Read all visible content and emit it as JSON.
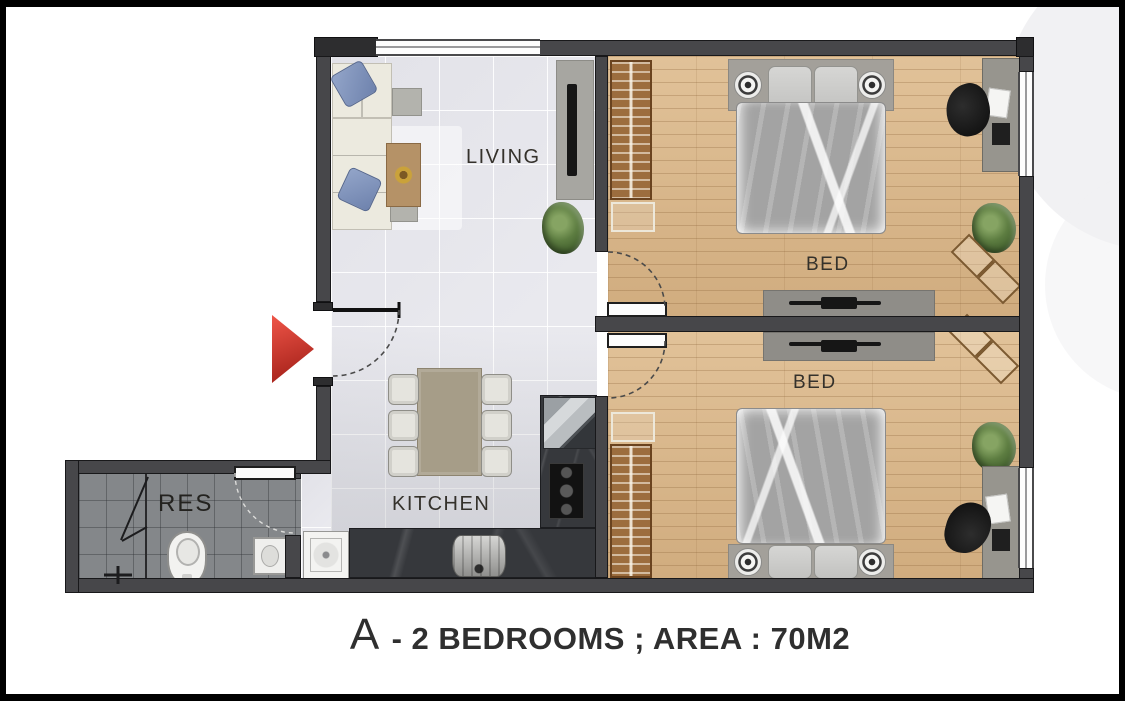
{
  "caption": {
    "letter": "A",
    "text": "- 2 BEDROOMS ; AREA : 70M2"
  },
  "rooms": [
    {
      "id": "living",
      "label": "LIVING"
    },
    {
      "id": "kitchen",
      "label": "KITCHEN"
    },
    {
      "id": "res",
      "label": "RES"
    },
    {
      "id": "bed-1",
      "label": "BED"
    },
    {
      "id": "bed-2",
      "label": "BED"
    }
  ],
  "plan": {
    "type": "apartment-floor-plan",
    "bedrooms": 2,
    "area_label": "70M2"
  },
  "colors": {
    "wall": "#47474a",
    "wood_floor": "#d7b487",
    "tile_floor": "#e9e9ee",
    "bathroom_floor": "#84878a",
    "counter": "#36383c",
    "entrance_arrow": "#c6271f",
    "plant": "#4a6a33",
    "frame": "#000000"
  }
}
